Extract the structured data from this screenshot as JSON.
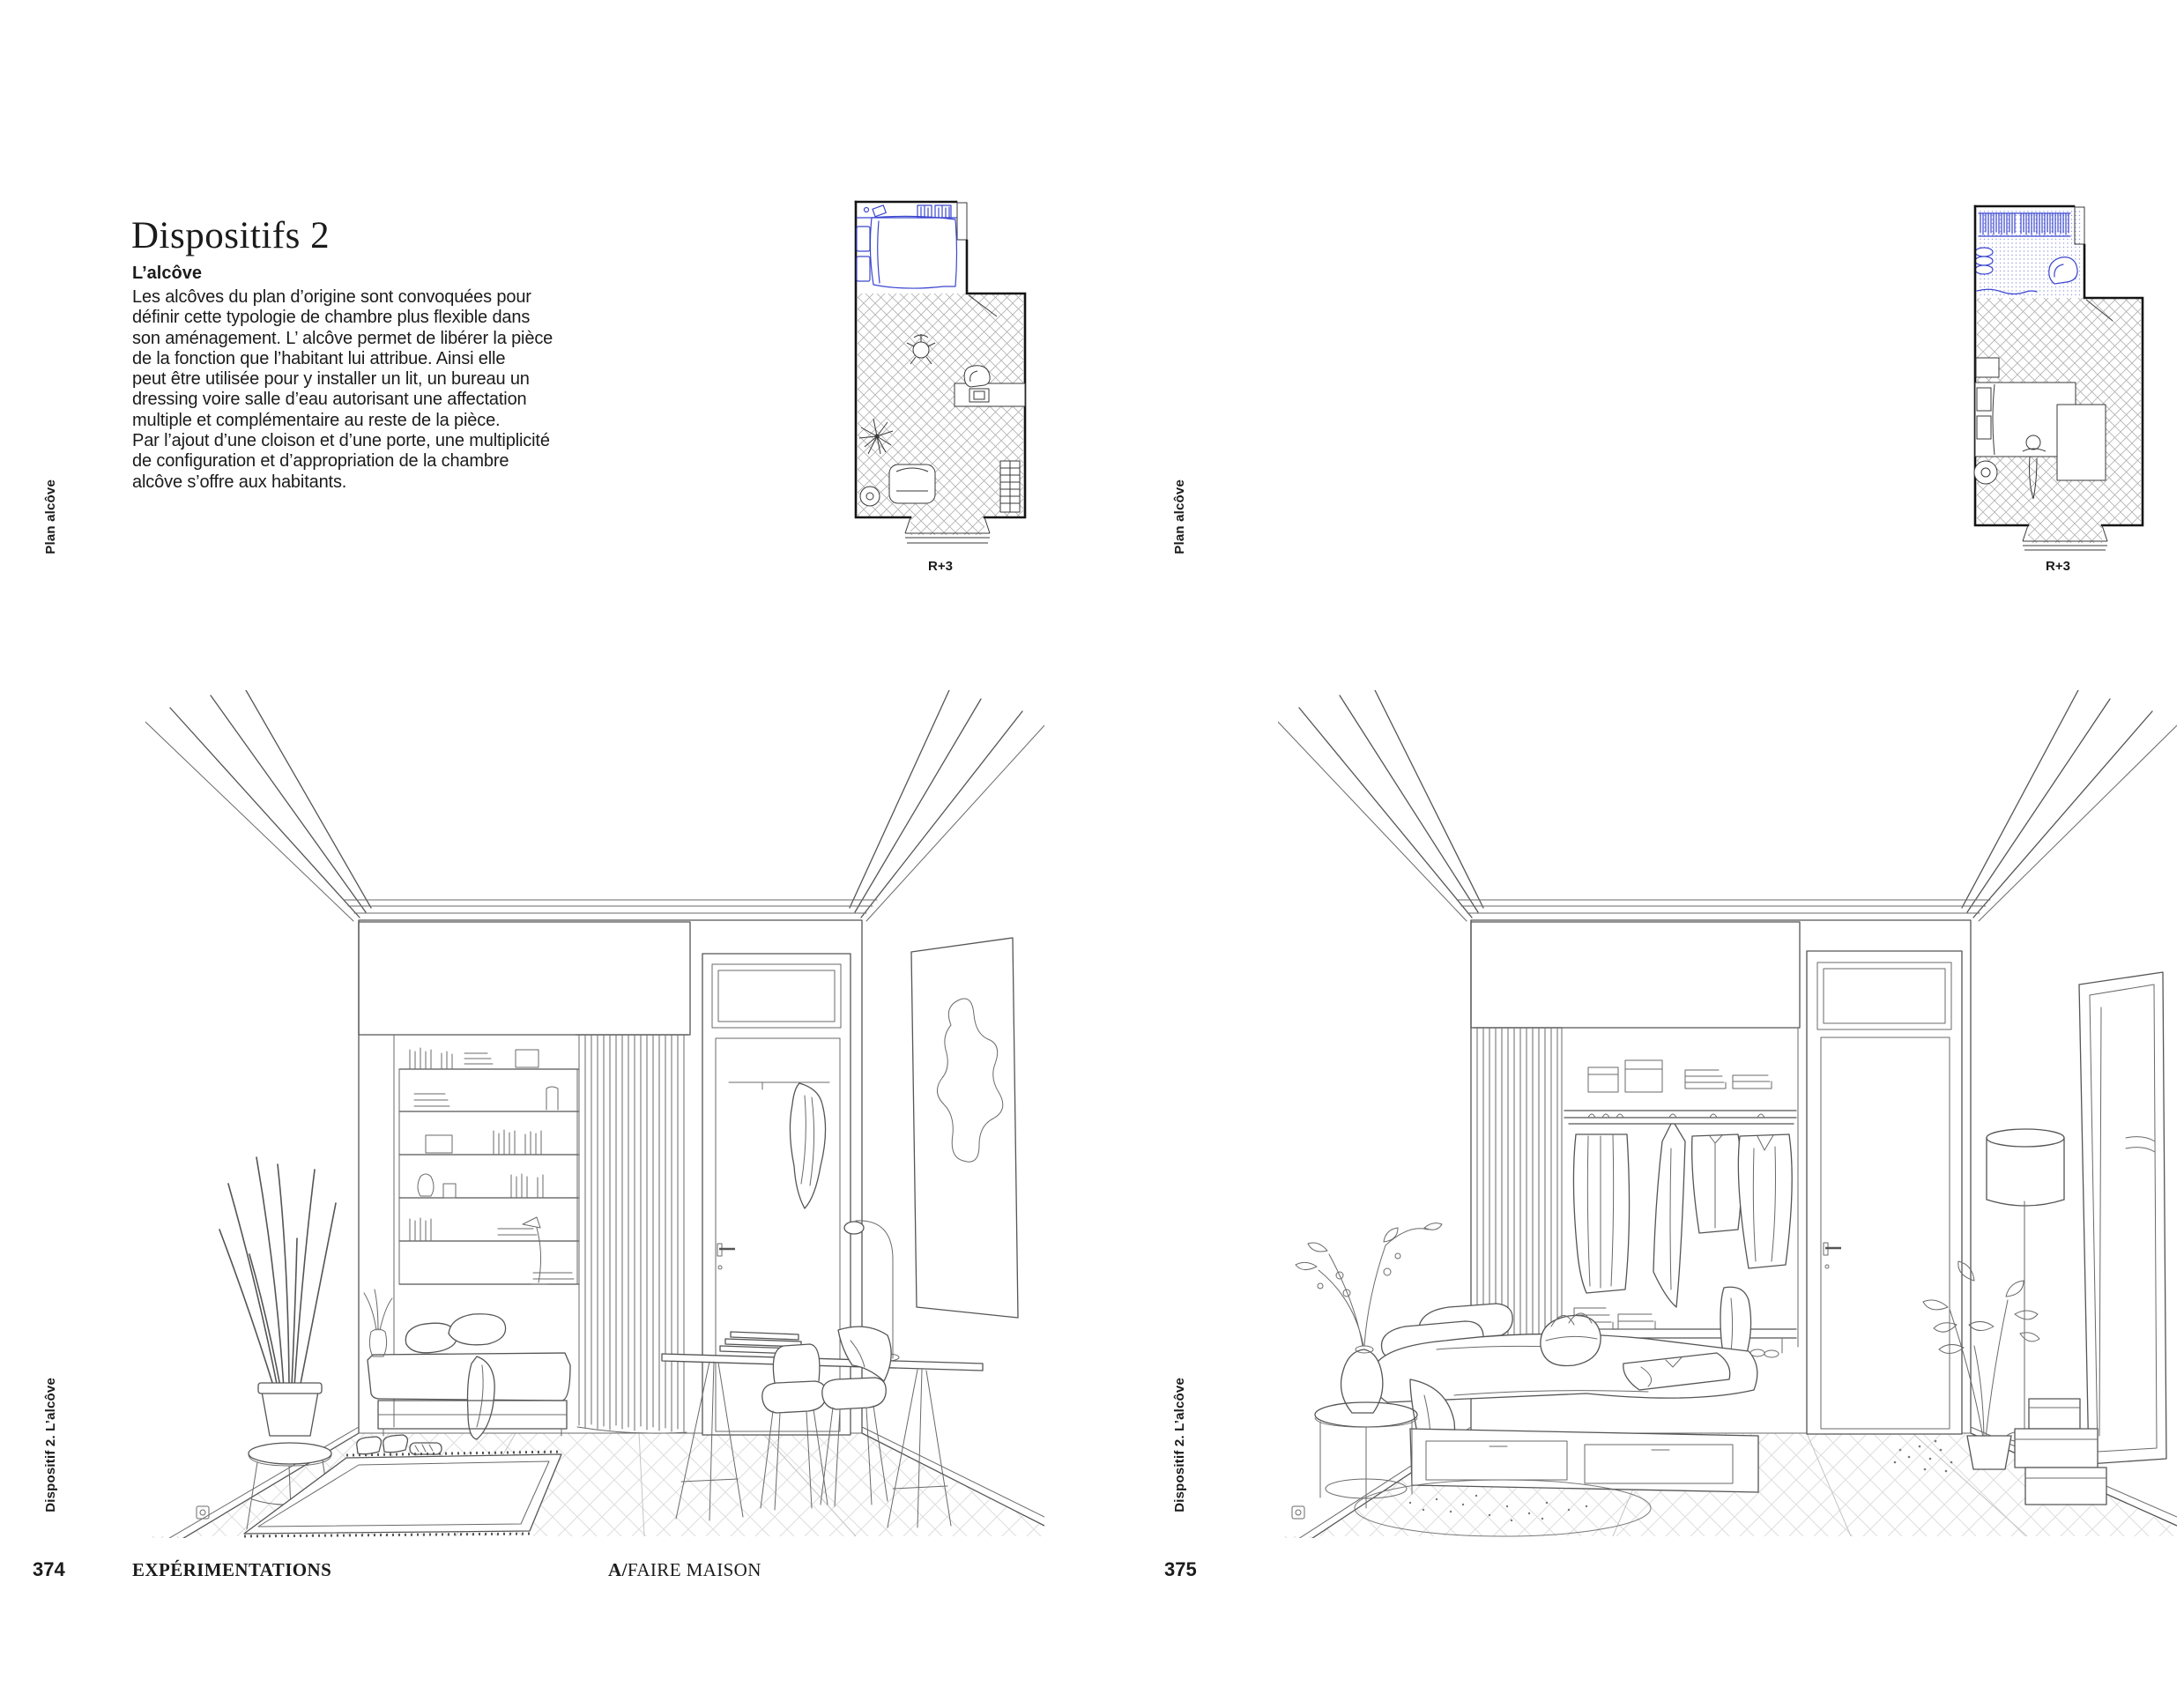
{
  "colors": {
    "accent_blue": "#3b46cf",
    "ink": "#1b1b1b",
    "drawing_line": "#555555"
  },
  "spread": {
    "left_page": {
      "page_number": "374",
      "title": "Dispositifs 2",
      "subtitle": "L’alcôve",
      "body_lines": [
        "Les alcôves du plan d’origine sont convoquées pour",
        "définir cette typologie de chambre plus flexible dans",
        "son aménagement. L’ alcôve permet de libérer la pièce",
        "de la fonction que l’habitant lui attribue. Ainsi elle",
        "peut être utilisée pour y installer un lit, un bureau un",
        "dressing voire salle d’eau autorisant une affectation",
        "multiple et complémentaire au reste de la pièce.",
        "Par l’ajout d’une cloison et d’une porte, une multiplicité",
        "de configuration et d’appropriation de la chambre",
        "alcôve s’offre aux habitants."
      ],
      "margin_caption_top": "Plan alcôve",
      "margin_caption_bottom": "Dispositif 2. L’alcôve",
      "plan_label": "R+3",
      "footer_section": "EXPÉRIMENTATIONS",
      "footer_book_bold": "A/",
      "footer_book_rest": "FAIRE MAISON"
    },
    "right_page": {
      "page_number": "375",
      "margin_caption_top": "Plan alcôve",
      "margin_caption_bottom": "Dispositif 2. L’alcôve",
      "plan_label": "R+3"
    }
  }
}
